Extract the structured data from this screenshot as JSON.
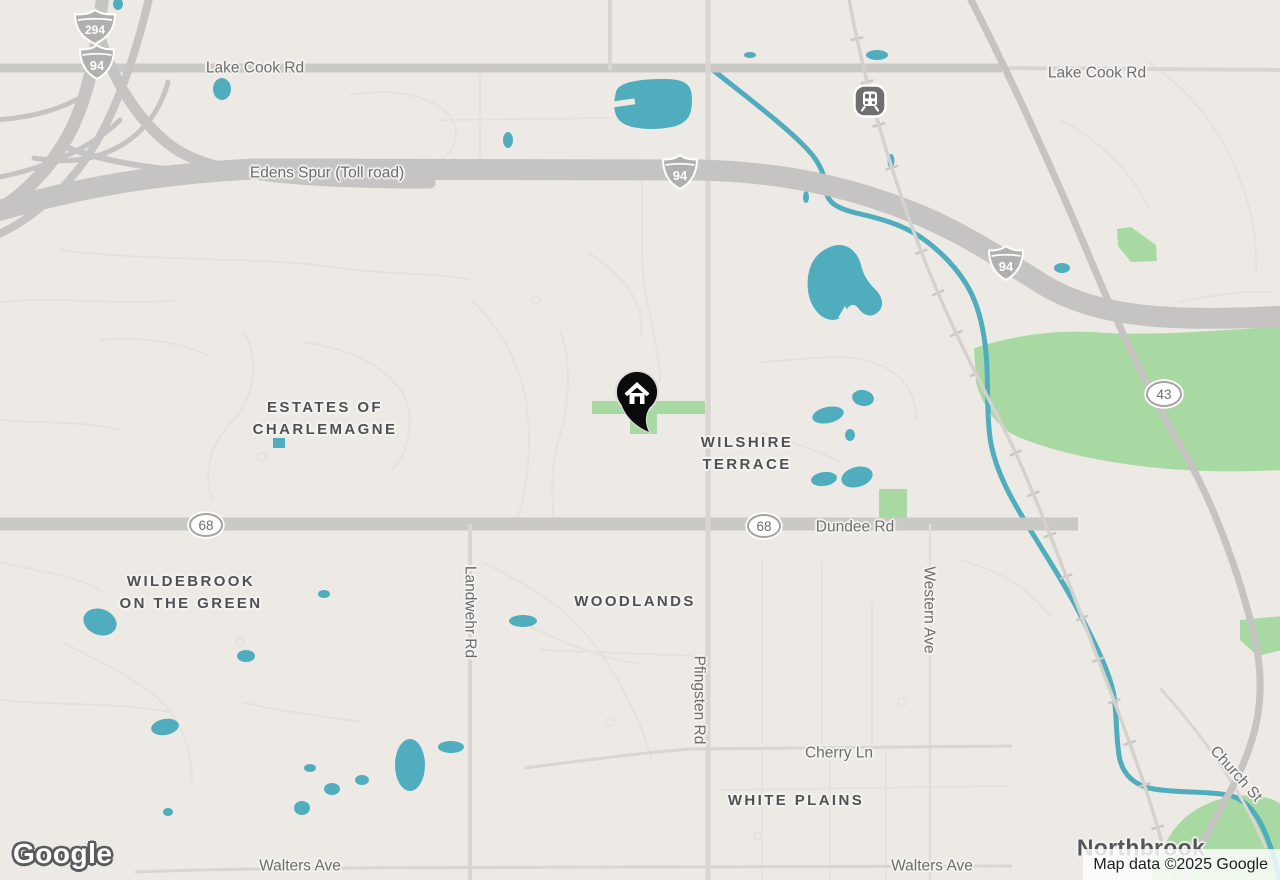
{
  "colors": {
    "bg": "#edeae6",
    "water": "#4fadbe",
    "park": "#a9d9a2",
    "hwy": "#c6c4c2",
    "art": "#cbc9c6",
    "minor_art": "#d8d6d3",
    "minor": "#e4e2de",
    "rail": "#d4d2cf",
    "rail_tick": "#c9c7c4",
    "lbl_road": "#6e6e6e",
    "lbl_area": "#4f5155",
    "lbl_city": "#54565a",
    "shield_fill": "#b2b0ae",
    "oval_border": "#a5a3a1",
    "oval_text": "#6f6f6f"
  },
  "road_labels": [
    {
      "text": "Lake Cook Rd"
    },
    {
      "text": "Lake Cook Rd"
    },
    {
      "text": "Edens Spur (Toll road)"
    },
    {
      "text": "Dundee Rd"
    },
    {
      "text": "Cherry Ln"
    },
    {
      "text": "Walters Ave"
    },
    {
      "text": "Walters Ave"
    },
    {
      "text": "Landwehr Rd"
    },
    {
      "text": "Pfingsten Rd"
    },
    {
      "text": "Western Ave"
    },
    {
      "text": "Church St"
    }
  ],
  "area_labels": [
    {
      "line1": "ESTATES OF",
      "line2": "CHARLEMAGNE"
    },
    {
      "line1": "WILSHIRE",
      "line2": "TERRACE"
    },
    {
      "line1": "WILDEBROOK",
      "line2": "ON THE GREEN"
    },
    {
      "line1": "WOODLANDS"
    },
    {
      "line1": "WHITE PLAINS"
    }
  ],
  "city_label": {
    "text": "Northbrook"
  },
  "shields": [
    {
      "type": "interstate",
      "text": "294"
    },
    {
      "type": "interstate",
      "text": "94"
    },
    {
      "type": "interstate",
      "text": "94"
    },
    {
      "type": "interstate",
      "text": "94"
    },
    {
      "type": "oval",
      "text": "68"
    },
    {
      "type": "oval",
      "text": "68"
    },
    {
      "type": "oval",
      "text": "43"
    }
  ],
  "markers": [
    {
      "name": "home-marker",
      "icon": "house-icon"
    },
    {
      "name": "train-station",
      "icon": "train-icon"
    }
  ],
  "brand": {
    "logo_text": "Google"
  },
  "attribution": {
    "text": "Map data ©2025 Google"
  }
}
